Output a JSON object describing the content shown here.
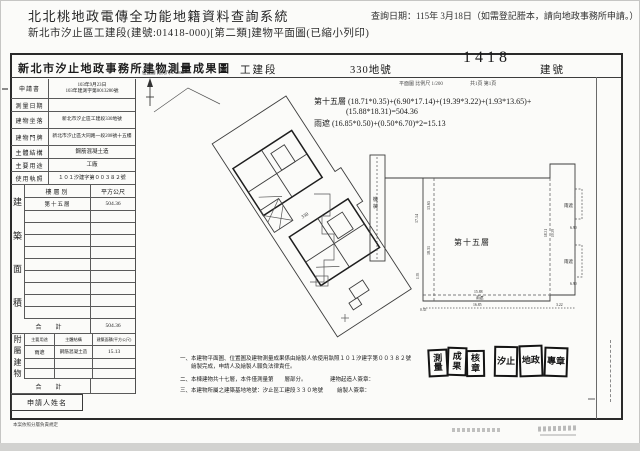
{
  "header": {
    "system_title": "北北桃地政電傳全功能地籍資料查詢系統",
    "doc_subtitle": "新北市汐止區工建段(建號:01418-000)[第二類]建物平面圖(已縮小列印)",
    "query_date": "查詢日期：115年 3月18日（如需登記謄本，請向地政事務所申請。）"
  },
  "doc_header": {
    "office_title": "新北市汐止地政事務所建物測量成果圖",
    "section_name": "工建段",
    "land_no": "330地號",
    "building_no": "1418",
    "building_no_unit": "建號",
    "scale_note": "平面圖 比例尺 1/200",
    "page_note": "共1頁 第1頁"
  },
  "info_table": {
    "rows": [
      {
        "label": "申請書",
        "value": "103年9月23日",
        "value2": "103年建測字第0013280號"
      },
      {
        "label": "測量日期",
        "value": "",
        "value2": ""
      },
      {
        "label": "建物坐落",
        "value": "新北市汐止區工建段330地號",
        "value2": ""
      },
      {
        "label": "建物門牌",
        "value": "新北市汐止區大同路一段208號十五樓",
        "value2": ""
      },
      {
        "label": "主體結構",
        "value": "鋼筋混凝土造",
        "value2": ""
      },
      {
        "label": "主要用途",
        "value": "工廠",
        "value2": ""
      },
      {
        "label": "使用執照",
        "value": "１０１汐建字第００３８２號",
        "value2": ""
      }
    ]
  },
  "area_table": {
    "side": [
      "建",
      "築",
      "面",
      "積"
    ],
    "col_floor": "樓層別",
    "col_area": "平方公尺",
    "floor_1": "第十五層",
    "area_1": "504.36",
    "total_label": "合　計",
    "total_value": "504.36"
  },
  "annex_table": {
    "side": [
      "附",
      "屬",
      "建",
      "物"
    ],
    "col_use": "主要用途",
    "col_structure": "主體結構",
    "col_area": "建築面積(平方公尺)",
    "use_1": "雨遮",
    "structure_1": "鋼筋混凝土造",
    "area_1": "15.13",
    "total_label": "合　計",
    "total_value": ""
  },
  "applicant_box_label": "申請人姓名",
  "footer_tiny_note": "本案依照分層負責規定",
  "site_plan": {
    "scale_label": "位置圖 比例尺 1/1500",
    "parcel_no": "330"
  },
  "formula": {
    "line1": "第十五層 (18.71*0.35)+(6.90*17.14)+(19.39*3.22)+(1.93*13.65)+",
    "line2": "(15.88*18.31)=504.36",
    "line3": "雨遮 (16.85*0.50)+(0.50*6.70)*2=15.13"
  },
  "floorplan": {
    "room_label": "第十五層",
    "machine_c1": "機",
    "machine_c2": "械",
    "canopy_top": "雨遮",
    "canopy_bottom": "雨遮",
    "canopy_edge": "雨遮",
    "dims": {
      "left_outer": "17.14",
      "left_a": "13.65",
      "left_b": "18.31",
      "small_a": "1.93",
      "small_b": "0.35",
      "right_a": "18.31",
      "right_b": "19.39",
      "canopy_h_top": "6.90",
      "canopy_h_bottom": "6.90",
      "bottom_main": "15.88",
      "bottom_canopy": "16.85",
      "bottom_right": "3.22"
    }
  },
  "notes": {
    "line1": "一、本建物平面圖、位置圖及建物測量成果係由繪製人依使用執照１０１汐建字第００３８２號",
    "line2": "　　繪製完成，申請人及繪製人願負法律責任。",
    "line3": "二、本棟建物共十七層，本件僅測量第　　層部分。",
    "line4": "三、本建物所屬之建築基地地號：汐止區工建段３３０地號",
    "sign1": "建物起造人簽章：",
    "sign2": "繪製人簽章："
  },
  "stamps": {
    "left": [
      "測量",
      "成果",
      "核章"
    ],
    "right": [
      "汐止",
      "地政",
      "專章"
    ]
  }
}
